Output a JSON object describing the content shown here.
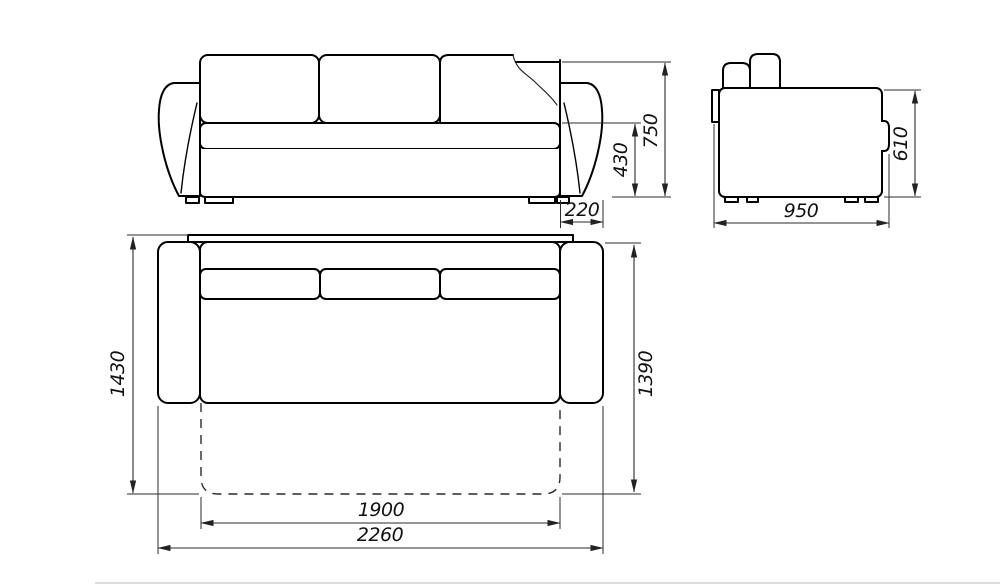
{
  "drawing": {
    "type": "sofa-orthographic-dimension-drawing",
    "line_color": "#000000",
    "dim_color": "#2b2b2b",
    "views": {
      "front": {
        "total_height_mm": "750",
        "seat_height_mm": "430",
        "armrest_width_mm": "220"
      },
      "side": {
        "depth_mm": "950",
        "height_mm": "610"
      },
      "plan": {
        "overall_depth_mm": "1430",
        "body_depth_mm": "1390",
        "sleeping_width_mm": "1900",
        "overall_width_mm": "2260"
      }
    }
  }
}
